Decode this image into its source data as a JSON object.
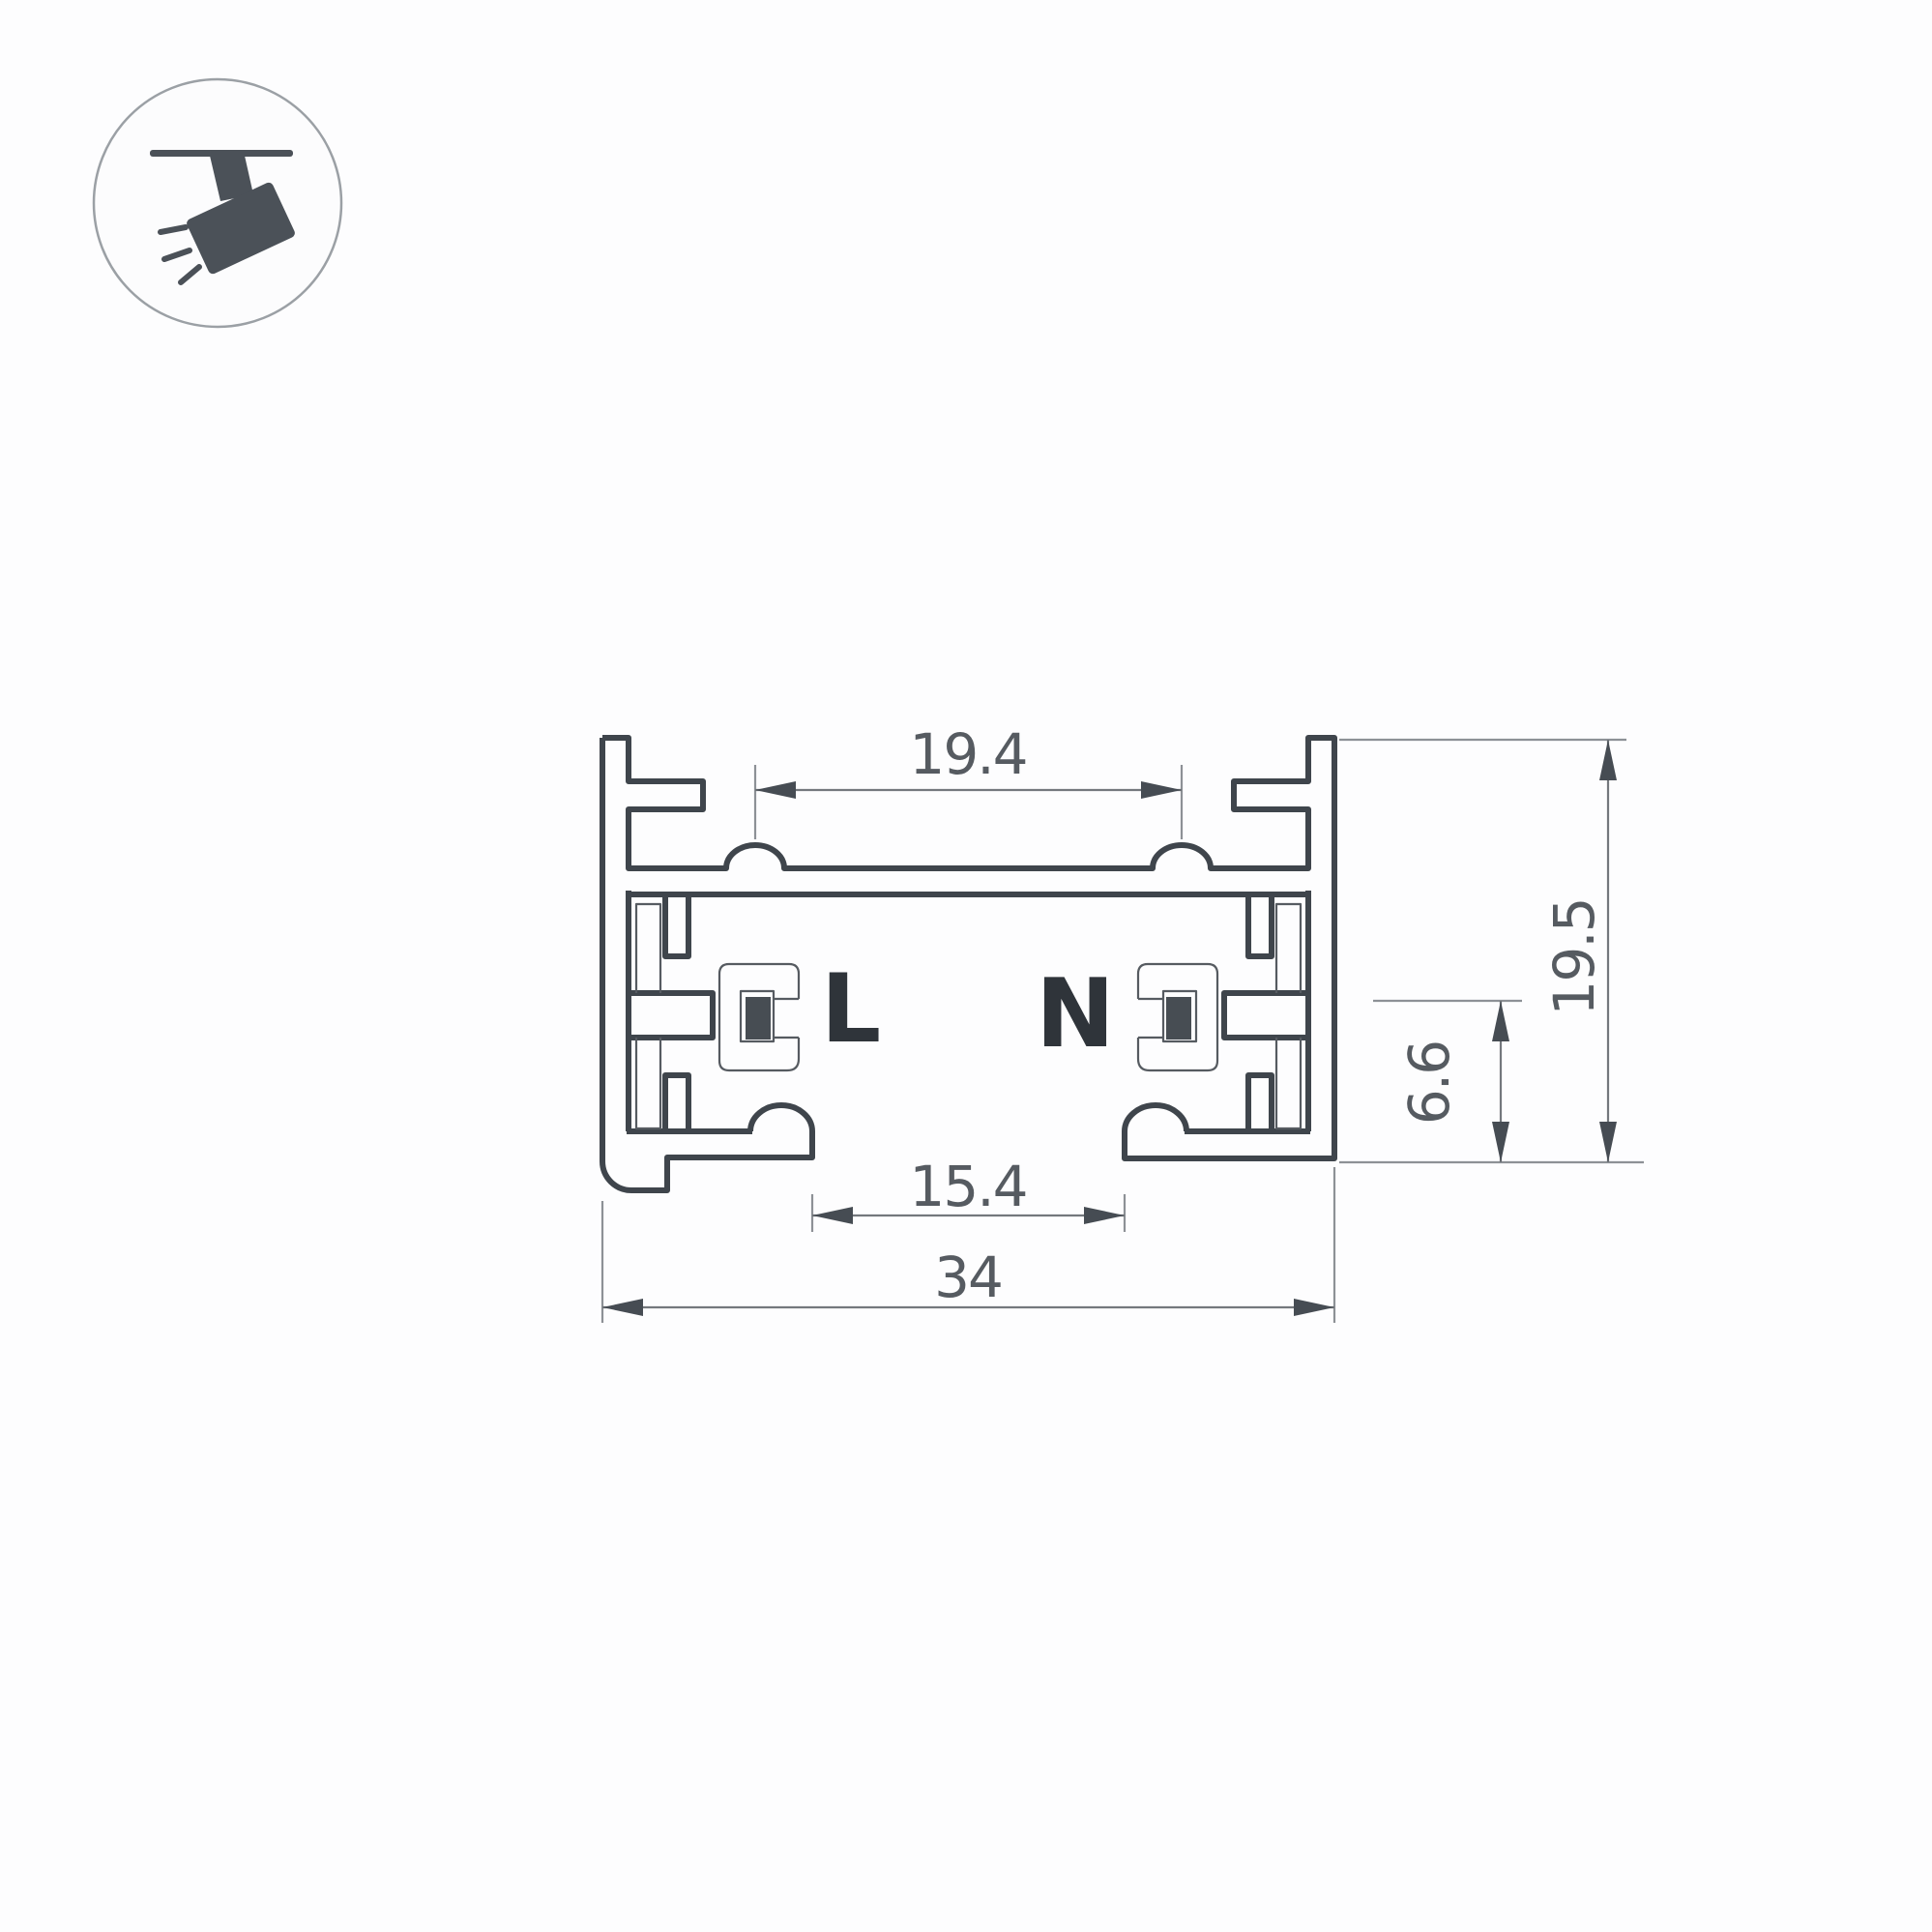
{
  "drawing": {
    "type": "technical-cross-section",
    "subject": "track lighting rail profile",
    "dimensions": {
      "slot_width": "19.4",
      "overall_height": "19.5",
      "contact_height": "6.6",
      "opening_width": "15.4",
      "overall_width": "34"
    },
    "conductors": {
      "live": "L",
      "neutral": "N"
    }
  },
  "icon": {
    "name": "track-spotlight-icon",
    "description": "ceiling track with tilted spotlight and light rays"
  },
  "colors": {
    "background": "#fdfdfe",
    "profile_line": "#3f454c",
    "insulator_line": "#565b61",
    "dimension_line": "#74787d",
    "extension_line": "#8d9196",
    "dimension_text": "#565b61",
    "conductor_label": "#2f343a",
    "conductor_fill": "#474d53",
    "icon": "#4b5158",
    "icon_circle_stroke": "#9ba0a5"
  }
}
